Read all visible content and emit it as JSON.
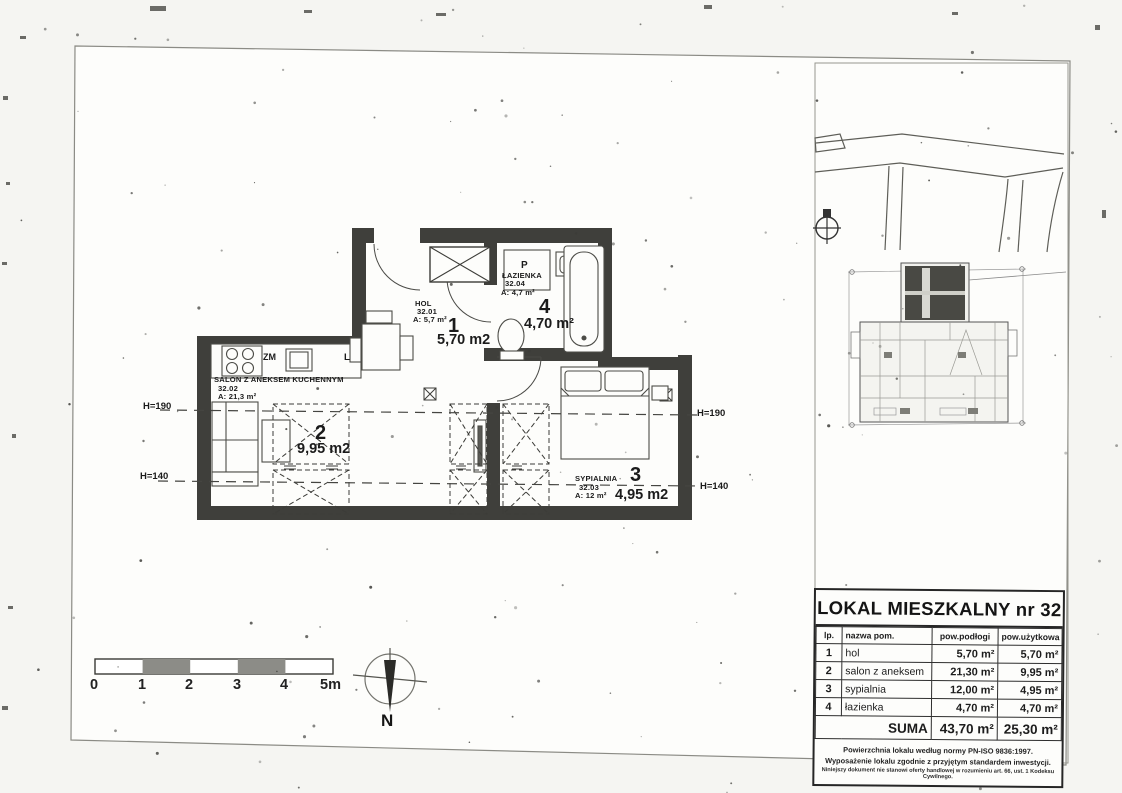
{
  "plan": {
    "rooms": {
      "hol": {
        "name": "HOL",
        "code": "32.01",
        "area_label": "A: 5,7 m²",
        "number": "1",
        "area": "5,70 m2"
      },
      "lazienka": {
        "name": "ŁAZIENKA",
        "code": "32.04",
        "area_label": "A: 4,7 m²",
        "number": "4",
        "area": "4,70 m²"
      },
      "salon": {
        "name": "SALON Z ANEKSEM KUCHENNYM",
        "code": "32.02",
        "area_label": "A: 21,3 m²",
        "number": "2",
        "area": "9,95 m2"
      },
      "sypialnia": {
        "name": "SYPIALNIA",
        "code": "32.03",
        "area_label": "A: 12 m²",
        "number": "3",
        "area": "4,95 m2"
      }
    },
    "fixtures": {
      "washer": "P",
      "sink": "ZM",
      "fridge": "L"
    },
    "height_lines": {
      "left_190": "H=190",
      "left_140": "H=140",
      "right_190": "H=190",
      "right_140": "H=140"
    }
  },
  "scale_bar": {
    "labels": [
      "0",
      "1",
      "2",
      "3",
      "4",
      "5m"
    ]
  },
  "compass": {
    "north": "N"
  },
  "info_table": {
    "title": "LOKAL MIESZKALNY nr 32",
    "headers": {
      "lp": "lp.",
      "name": "nazwa pom.",
      "floor_area": "pow.podłogi",
      "usable_area": "pow.użytkowa"
    },
    "rows": [
      {
        "lp": "1",
        "name": "hol",
        "floor": "5,70 m²",
        "usable": "5,70 m²"
      },
      {
        "lp": "2",
        "name": "salon z aneksem",
        "floor": "21,30 m²",
        "usable": "9,95 m²"
      },
      {
        "lp": "3",
        "name": "sypialnia",
        "floor": "12,00 m²",
        "usable": "4,95 m²"
      },
      {
        "lp": "4",
        "name": "łazienka",
        "floor": "4,70 m²",
        "usable": "4,70 m²"
      }
    ],
    "summary": {
      "label": "SUMA",
      "floor": "43,70 m²",
      "usable": "25,30 m²"
    },
    "notes": [
      "Powierzchnia lokalu według normy PN-ISO 9836:1997.",
      "Wyposażenie lokalu zgodnie z przyjętym standardem inwestycji.",
      "Niniejszy dokument nie stanowi oferty handlowej w rozumieniu art. 66, ust. 1 Kodeksu Cywilnego."
    ]
  }
}
